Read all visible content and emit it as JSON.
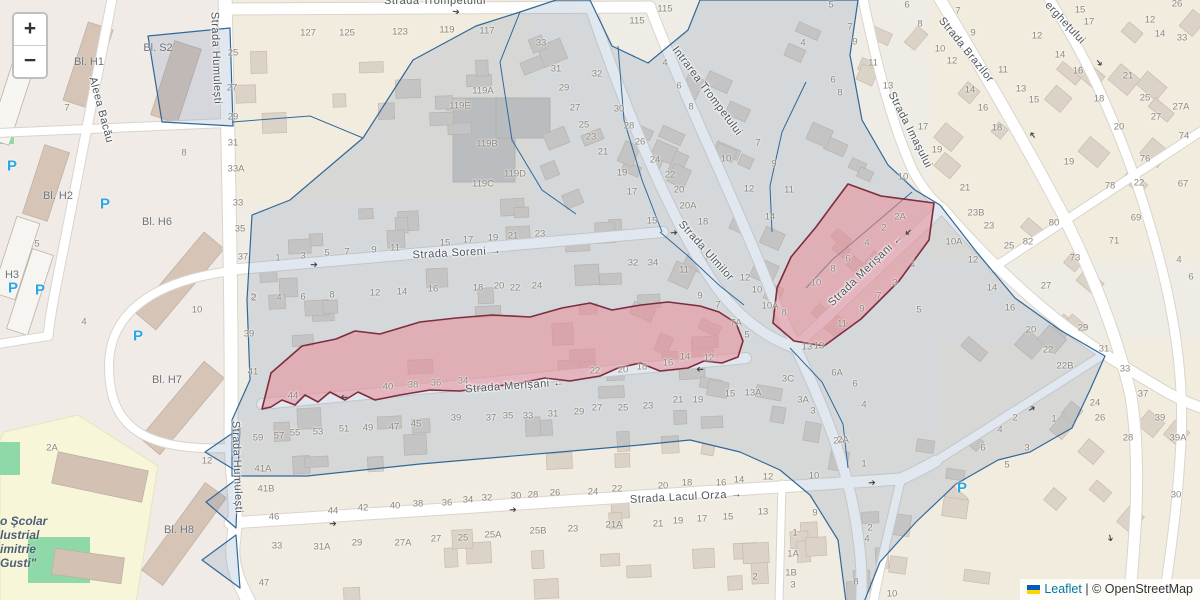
{
  "window": {
    "width": 1200,
    "height": 600
  },
  "controls": {
    "zoom_in_label": "+",
    "zoom_out_label": "−"
  },
  "attribution": {
    "flag_icon": "ukraine-flag",
    "leaflet_link": "Leaflet",
    "separator": "|",
    "copyright": "© OpenStreetMap"
  },
  "overlays": {
    "highlighted_street": "Strada Merișani",
    "blue_border": "#31689a",
    "blue_fill": "rgba(120,145,180,0.22)",
    "red_border": "#7d2d3e",
    "red_fill": "rgba(233,140,152,0.55)"
  },
  "colors": {
    "parking_blue": "#2ba7e4",
    "link_blue": "#0078A8",
    "school_yellow": "#f7f6d8",
    "grass_green": "#8fd9a8",
    "flag_blue": "#005BBB",
    "flag_yellow": "#FFD500",
    "road_white": "#ffffff",
    "building_fill": "#dbd3c8",
    "building_stroke": "#c9bbab"
  },
  "icons": {
    "parking": "P",
    "oneway_arrow": "➔"
  },
  "street_labels": [
    {
      "t": "Strada Trompetului",
      "x": 435,
      "y": 1,
      "r": 0,
      "a": ""
    },
    {
      "t": "Strada Humulești",
      "x": 216,
      "y": 58,
      "r": 88,
      "a": ""
    },
    {
      "t": "Aleea Bacău",
      "x": 101,
      "y": 110,
      "r": 75,
      "a": ""
    },
    {
      "t": "Intrarea Trompetului",
      "x": 707,
      "y": 91,
      "r": 53,
      "a": ""
    },
    {
      "t": "Strada Brazilor",
      "x": 966,
      "y": 50,
      "r": 51,
      "a": ""
    },
    {
      "t": "erghețului",
      "x": 1065,
      "y": 23,
      "r": 47,
      "a": ""
    },
    {
      "t": "Strada Imașului",
      "x": 910,
      "y": 130,
      "r": 63,
      "a": ""
    },
    {
      "t": "Strada Soreni",
      "x": 457,
      "y": 253,
      "r": -3,
      "a": "→"
    },
    {
      "t": "Strada Ulmilor",
      "x": 706,
      "y": 251,
      "r": 48,
      "a": ""
    },
    {
      "t": "Strada Merișani",
      "x": 515,
      "y": 386,
      "r": -4,
      "a": "←"
    },
    {
      "t": "Strada Merișani",
      "x": 866,
      "y": 270,
      "r": -44,
      "a": "←"
    },
    {
      "t": "Strada Lacul Orza",
      "x": 686,
      "y": 497,
      "r": -3,
      "a": "→"
    },
    {
      "t": "Strada Humulești",
      "x": 237,
      "y": 467,
      "r": 88,
      "a": ""
    }
  ],
  "block_labels": [
    {
      "t": "Bl. H1",
      "x": 89,
      "y": 62
    },
    {
      "t": "Bl. S2",
      "x": 158,
      "y": 48
    },
    {
      "t": "Bl. H2",
      "x": 58,
      "y": 196
    },
    {
      "t": "H3",
      "x": 12,
      "y": 275
    },
    {
      "t": "Bl. H6",
      "x": 157,
      "y": 222
    },
    {
      "t": "Bl. H7",
      "x": 167,
      "y": 380
    },
    {
      "t": "Bl. H8",
      "x": 179,
      "y": 530
    }
  ],
  "school_labels": [
    {
      "t": "o Şcolar",
      "x": 0,
      "y": 514
    },
    {
      "t": "lustrial",
      "x": 0,
      "y": 528
    },
    {
      "t": "imitrie",
      "x": 0,
      "y": 542
    },
    {
      "t": "Gusti\"",
      "x": 0,
      "y": 556
    }
  ],
  "parking_positions": [
    [
      12,
      166
    ],
    [
      13,
      288
    ],
    [
      40,
      290
    ],
    [
      105,
      204
    ],
    [
      138,
      336
    ],
    [
      962,
      488
    ]
  ],
  "oneway_arrows": [
    [
      314,
      265,
      0
    ],
    [
      456,
      12,
      8
    ],
    [
      674,
      233,
      -4
    ],
    [
      344,
      397,
      180
    ],
    [
      700,
      369,
      180
    ],
    [
      908,
      232,
      138
    ],
    [
      1099,
      63,
      52
    ],
    [
      1033,
      135,
      232
    ],
    [
      333,
      524,
      -4
    ],
    [
      513,
      510,
      -4
    ],
    [
      872,
      483,
      -4
    ],
    [
      1032,
      409,
      -33
    ],
    [
      1110,
      538,
      78
    ]
  ],
  "house_numbers": [
    [
      "25",
      233,
      53
    ],
    [
      "27",
      232,
      88
    ],
    [
      "29",
      233,
      117
    ],
    [
      "31",
      233,
      143
    ],
    [
      "33A",
      236,
      169
    ],
    [
      "33",
      238,
      203
    ],
    [
      "35",
      240,
      229
    ],
    [
      "37",
      243,
      257
    ],
    [
      "2",
      253,
      297
    ],
    [
      "39",
      249,
      334
    ],
    [
      "41",
      253,
      372
    ],
    [
      "7",
      67,
      108
    ],
    [
      "8",
      184,
      153
    ],
    [
      "5",
      37,
      244
    ],
    [
      "4",
      84,
      322
    ],
    [
      "10",
      197,
      310
    ],
    [
      "2A",
      52,
      448
    ],
    [
      "12",
      207,
      461
    ],
    [
      "127",
      308,
      33
    ],
    [
      "125",
      347,
      33
    ],
    [
      "123",
      400,
      32
    ],
    [
      "119",
      447,
      30
    ],
    [
      "117",
      487,
      31
    ],
    [
      "119A",
      483,
      91
    ],
    [
      "119E",
      460,
      106
    ],
    [
      "119B",
      487,
      144
    ],
    [
      "119D",
      515,
      174
    ],
    [
      "119C",
      483,
      184
    ],
    [
      "115",
      637,
      21
    ],
    [
      "115",
      665,
      9
    ],
    [
      "33",
      541,
      43
    ],
    [
      "31",
      556,
      69
    ],
    [
      "29",
      564,
      88
    ],
    [
      "27",
      575,
      108
    ],
    [
      "25",
      584,
      125
    ],
    [
      "23",
      591,
      137
    ],
    [
      "21",
      603,
      152
    ],
    [
      "19",
      622,
      173
    ],
    [
      "17",
      632,
      192
    ],
    [
      "32",
      597,
      74
    ],
    [
      "30",
      619,
      109
    ],
    [
      "28",
      629,
      126
    ],
    [
      "26",
      640,
      142
    ],
    [
      "24",
      655,
      160
    ],
    [
      "22",
      670,
      175
    ],
    [
      "20",
      679,
      190
    ],
    [
      "20A",
      688,
      206
    ],
    [
      "18",
      703,
      222
    ],
    [
      "15",
      652,
      221
    ],
    [
      "4",
      665,
      63
    ],
    [
      "6",
      679,
      86
    ],
    [
      "8",
      691,
      107
    ],
    [
      "10",
      726,
      159
    ],
    [
      "12",
      749,
      189
    ],
    [
      "7",
      758,
      143
    ],
    [
      "9",
      774,
      164
    ],
    [
      "11",
      789,
      190
    ],
    [
      "14",
      770,
      217
    ],
    [
      "4",
      803,
      43
    ],
    [
      "6",
      833,
      80
    ],
    [
      "8",
      840,
      93
    ],
    [
      "5",
      831,
      5
    ],
    [
      "7",
      850,
      27
    ],
    [
      "9",
      855,
      42
    ],
    [
      "11",
      873,
      63
    ],
    [
      "13",
      888,
      86
    ],
    [
      "32",
      633,
      263
    ],
    [
      "34",
      653,
      263
    ],
    [
      "11",
      684,
      270
    ],
    [
      "9",
      700,
      296
    ],
    [
      "7",
      718,
      305
    ],
    [
      "7A",
      736,
      323
    ],
    [
      "5",
      747,
      335
    ],
    [
      "12",
      745,
      278
    ],
    [
      "10",
      757,
      290
    ],
    [
      "10A",
      770,
      306
    ],
    [
      "8",
      784,
      313
    ],
    [
      "13",
      807,
      347
    ],
    [
      "1",
      278,
      258
    ],
    [
      "3",
      303,
      256
    ],
    [
      "5",
      327,
      253
    ],
    [
      "7",
      347,
      252
    ],
    [
      "9",
      374,
      250
    ],
    [
      "11",
      395,
      248
    ],
    [
      "15",
      445,
      243
    ],
    [
      "17",
      468,
      240
    ],
    [
      "19",
      493,
      238
    ],
    [
      "21",
      513,
      236
    ],
    [
      "23",
      540,
      234
    ],
    [
      "2",
      254,
      298
    ],
    [
      "4",
      279,
      298
    ],
    [
      "6",
      303,
      297
    ],
    [
      "8",
      332,
      295
    ],
    [
      "12",
      375,
      293
    ],
    [
      "14",
      402,
      292
    ],
    [
      "16",
      433,
      289
    ],
    [
      "18",
      478,
      288
    ],
    [
      "20",
      499,
      286
    ],
    [
      "22",
      515,
      288
    ],
    [
      "24",
      537,
      286
    ],
    [
      "44",
      293,
      396
    ],
    [
      "40",
      388,
      387
    ],
    [
      "38",
      413,
      385
    ],
    [
      "36",
      436,
      383
    ],
    [
      "34",
      463,
      381
    ],
    [
      "22",
      595,
      371
    ],
    [
      "20",
      623,
      370
    ],
    [
      "18",
      642,
      367
    ],
    [
      "16",
      668,
      363
    ],
    [
      "14",
      685,
      357
    ],
    [
      "12",
      709,
      358
    ],
    [
      "59",
      258,
      438
    ],
    [
      "57",
      279,
      436
    ],
    [
      "55",
      295,
      433
    ],
    [
      "53",
      318,
      432
    ],
    [
      "51",
      344,
      429
    ],
    [
      "49",
      368,
      428
    ],
    [
      "47",
      394,
      427
    ],
    [
      "45",
      416,
      424
    ],
    [
      "39",
      456,
      418
    ],
    [
      "37",
      491,
      418
    ],
    [
      "35",
      508,
      416
    ],
    [
      "33",
      528,
      416
    ],
    [
      "31",
      553,
      414
    ],
    [
      "29",
      579,
      412
    ],
    [
      "27",
      597,
      408
    ],
    [
      "25",
      623,
      408
    ],
    [
      "23",
      648,
      406
    ],
    [
      "21",
      678,
      400
    ],
    [
      "19",
      698,
      400
    ],
    [
      "15",
      730,
      394
    ],
    [
      "13A",
      753,
      393
    ],
    [
      "41A",
      263,
      469
    ],
    [
      "41B",
      266,
      489
    ],
    [
      "46",
      274,
      517
    ],
    [
      "44",
      333,
      511
    ],
    [
      "42",
      363,
      508
    ],
    [
      "40",
      395,
      506
    ],
    [
      "38",
      418,
      504
    ],
    [
      "36",
      447,
      503
    ],
    [
      "34",
      468,
      500
    ],
    [
      "32",
      487,
      498
    ],
    [
      "30",
      516,
      496
    ],
    [
      "28",
      533,
      495
    ],
    [
      "26",
      555,
      493
    ],
    [
      "24",
      593,
      492
    ],
    [
      "22",
      617,
      489
    ],
    [
      "20",
      663,
      486
    ],
    [
      "18",
      687,
      483
    ],
    [
      "16",
      721,
      483
    ],
    [
      "14",
      739,
      480
    ],
    [
      "12",
      768,
      477
    ],
    [
      "10",
      814,
      476
    ],
    [
      "33",
      277,
      546
    ],
    [
      "31A",
      322,
      547
    ],
    [
      "29",
      357,
      543
    ],
    [
      "27A",
      403,
      543
    ],
    [
      "27",
      436,
      539
    ],
    [
      "25",
      463,
      538
    ],
    [
      "25A",
      493,
      535
    ],
    [
      "25B",
      538,
      531
    ],
    [
      "23",
      573,
      529
    ],
    [
      "21A",
      614,
      525
    ],
    [
      "21",
      658,
      524
    ],
    [
      "19",
      678,
      521
    ],
    [
      "17",
      702,
      519
    ],
    [
      "15",
      728,
      517
    ],
    [
      "13",
      763,
      512
    ],
    [
      "47",
      264,
      583
    ],
    [
      "9",
      815,
      513
    ],
    [
      "1",
      795,
      533
    ],
    [
      "1A",
      793,
      554
    ],
    [
      "1B",
      791,
      573
    ],
    [
      "3",
      793,
      585
    ],
    [
      "2",
      870,
      528
    ],
    [
      "4",
      867,
      539
    ],
    [
      "8",
      856,
      582
    ],
    [
      "2",
      755,
      577
    ],
    [
      "10",
      892,
      594
    ],
    [
      "2A",
      839,
      441
    ],
    [
      "1",
      864,
      464
    ],
    [
      "13",
      819,
      346
    ],
    [
      "6A",
      837,
      373
    ],
    [
      "6",
      855,
      384
    ],
    [
      "4",
      864,
      405
    ],
    [
      "3C",
      788,
      379
    ],
    [
      "3A",
      803,
      400
    ],
    [
      "3",
      813,
      411
    ],
    [
      "2A",
      843,
      440
    ],
    [
      "2A",
      900,
      217
    ],
    [
      "2",
      884,
      228
    ],
    [
      "4",
      867,
      243
    ],
    [
      "6",
      848,
      259
    ],
    [
      "8",
      833,
      269
    ],
    [
      "10",
      816,
      283
    ],
    [
      "10",
      903,
      177
    ],
    [
      "1",
      913,
      264
    ],
    [
      "3",
      895,
      283
    ],
    [
      "7",
      879,
      296
    ],
    [
      "9",
      862,
      309
    ],
    [
      "5",
      919,
      310
    ],
    [
      "11",
      842,
      324
    ],
    [
      "21",
      965,
      188
    ],
    [
      "23B",
      976,
      213
    ],
    [
      "23",
      989,
      226
    ],
    [
      "10A",
      954,
      242
    ],
    [
      "12",
      973,
      260
    ],
    [
      "14",
      992,
      288
    ],
    [
      "16",
      1010,
      308
    ],
    [
      "20",
      1031,
      330
    ],
    [
      "22",
      1048,
      350
    ],
    [
      "25",
      1009,
      246
    ],
    [
      "27",
      1046,
      286
    ],
    [
      "29",
      1083,
      328
    ],
    [
      "31",
      1104,
      349
    ],
    [
      "17",
      923,
      127
    ],
    [
      "19",
      937,
      150
    ],
    [
      "6",
      907,
      5
    ],
    [
      "8",
      920,
      24
    ],
    [
      "10",
      940,
      49
    ],
    [
      "12",
      952,
      61
    ],
    [
      "14",
      970,
      90
    ],
    [
      "16",
      983,
      108
    ],
    [
      "18",
      997,
      128
    ],
    [
      "7",
      958,
      11
    ],
    [
      "9",
      973,
      33
    ],
    [
      "11",
      1003,
      70
    ],
    [
      "13",
      1021,
      89
    ],
    [
      "15",
      1034,
      100
    ],
    [
      "12",
      1037,
      36
    ],
    [
      "14",
      1060,
      55
    ],
    [
      "16",
      1078,
      71
    ],
    [
      "18",
      1099,
      99
    ],
    [
      "20",
      1119,
      127
    ],
    [
      "22",
      1139,
      183
    ],
    [
      "19",
      1069,
      162
    ],
    [
      "15",
      1080,
      10
    ],
    [
      "17",
      1089,
      22
    ],
    [
      "12",
      1150,
      20
    ],
    [
      "14",
      1160,
      34
    ],
    [
      "33",
      1182,
      38
    ],
    [
      "26",
      1177,
      4
    ],
    [
      "21",
      1128,
      76
    ],
    [
      "25",
      1145,
      98
    ],
    [
      "27A",
      1181,
      107
    ],
    [
      "27",
      1156,
      117
    ],
    [
      "74",
      1184,
      136
    ],
    [
      "76",
      1145,
      159
    ],
    [
      "67",
      1183,
      184
    ],
    [
      "78",
      1110,
      186
    ],
    [
      "80",
      1054,
      223
    ],
    [
      "82",
      1028,
      242
    ],
    [
      "69",
      1136,
      218
    ],
    [
      "71",
      1114,
      241
    ],
    [
      "73",
      1075,
      258
    ],
    [
      "4",
      1179,
      260
    ],
    [
      "6",
      1191,
      277
    ],
    [
      "22B",
      1065,
      366
    ],
    [
      "33",
      1125,
      369
    ],
    [
      "37",
      1143,
      394
    ],
    [
      "39",
      1160,
      418
    ],
    [
      "39A",
      1178,
      438
    ],
    [
      "24",
      1095,
      403
    ],
    [
      "26",
      1100,
      418
    ],
    [
      "28",
      1128,
      438
    ],
    [
      "30",
      1176,
      495
    ],
    [
      "1",
      1054,
      419
    ],
    [
      "2",
      1015,
      418
    ],
    [
      "3",
      1027,
      448
    ],
    [
      "4",
      1000,
      430
    ],
    [
      "5",
      1007,
      465
    ],
    [
      "6",
      983,
      448
    ]
  ]
}
